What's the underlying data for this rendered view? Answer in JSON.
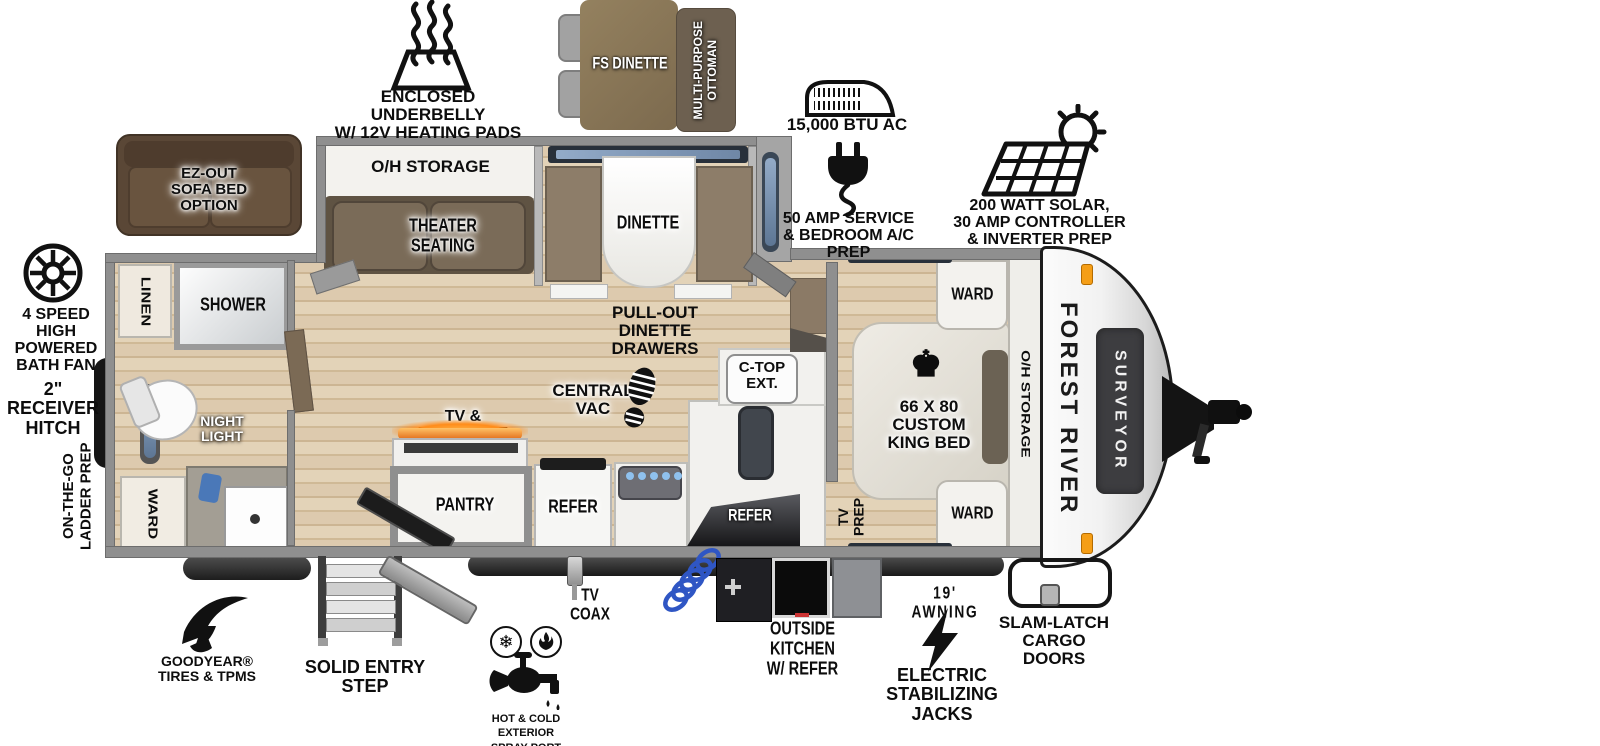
{
  "brand": {
    "manufacturer": "FOREST RIVER",
    "model": "SURVEYOR"
  },
  "callouts": {
    "underbelly": "ENCLOSED UNDERBELLY\nW/ 12V HEATING PADS",
    "fs_dinette": "FS DINETTE",
    "ottoman": "MULTI-PURPOSE\nOTTOMAN",
    "ac": "15,000 BTU AC",
    "service": "50 AMP SERVICE\n& BEDROOM A/C PREP",
    "solar": "200 WATT SOLAR,\n30 AMP CONTROLLER\n& INVERTER PREP",
    "bath_fan": "4 SPEED\nHIGH POWERED\nBATH FAN",
    "receiver_hitch": "2\" RECEIVER\nHITCH",
    "ladder_prep": "ON-THE-GO\nLADDER PREP",
    "goodyear": "GOODYEAR®\nTIRES & TPMS",
    "entry_step": "SOLID ENTRY\nSTEP",
    "spray_port": "HOT & COLD EXTERIOR\nSPRAY PORT",
    "tv_coax": "TV\nCOAX",
    "outside_kitchen": "OUTSIDE KITCHEN\nW/ REFER",
    "awning": "19' AWNING",
    "stab_jacks": "ELECTRIC\nSTABILIZING\nJACKS",
    "cargo_doors": "SLAM-LATCH\nCARGO DOORS",
    "sofa_option": "EZ-OUT\nSOFA BED\nOPTION"
  },
  "rooms": {
    "bathroom": {
      "linen": "LINEN",
      "shower": "SHOWER",
      "night_light": "NIGHT\nLIGHT",
      "ward": "WARD"
    },
    "living": {
      "oh_storage": "O/H STORAGE",
      "theater": "THEATER\nSEATING",
      "dinette": "DINETTE",
      "pullout": "PULL-OUT\nDINETTE DRAWERS",
      "central_vac": "CENTRAL\nVAC",
      "tv_fireplace": "TV & FIREPLACE",
      "pantry": "PANTRY",
      "refer": "REFER",
      "ctop": "C-TOP\nEXT.",
      "outside_refer": "REFER"
    },
    "bedroom": {
      "ward_top": "WARD",
      "ward_bottom": "WARD",
      "bed": "66 X 80\nCUSTOM\nKING BED",
      "oh_storage": "O/H STORAGE",
      "tv_prep": "TV\nPREP"
    }
  },
  "colors": {
    "floor_wood": "#ddcaae",
    "wall_gray": "#8f8f8f",
    "furniture_brown": "#6e6050",
    "sofa_brown": "#5a4736",
    "marker_orange": "#f59e16",
    "window_blue": "#7e95b8",
    "fireplace_orange": "#f08a1d",
    "hose_blue": "#2f56c4",
    "surveyor_box": "#3d3d40"
  }
}
